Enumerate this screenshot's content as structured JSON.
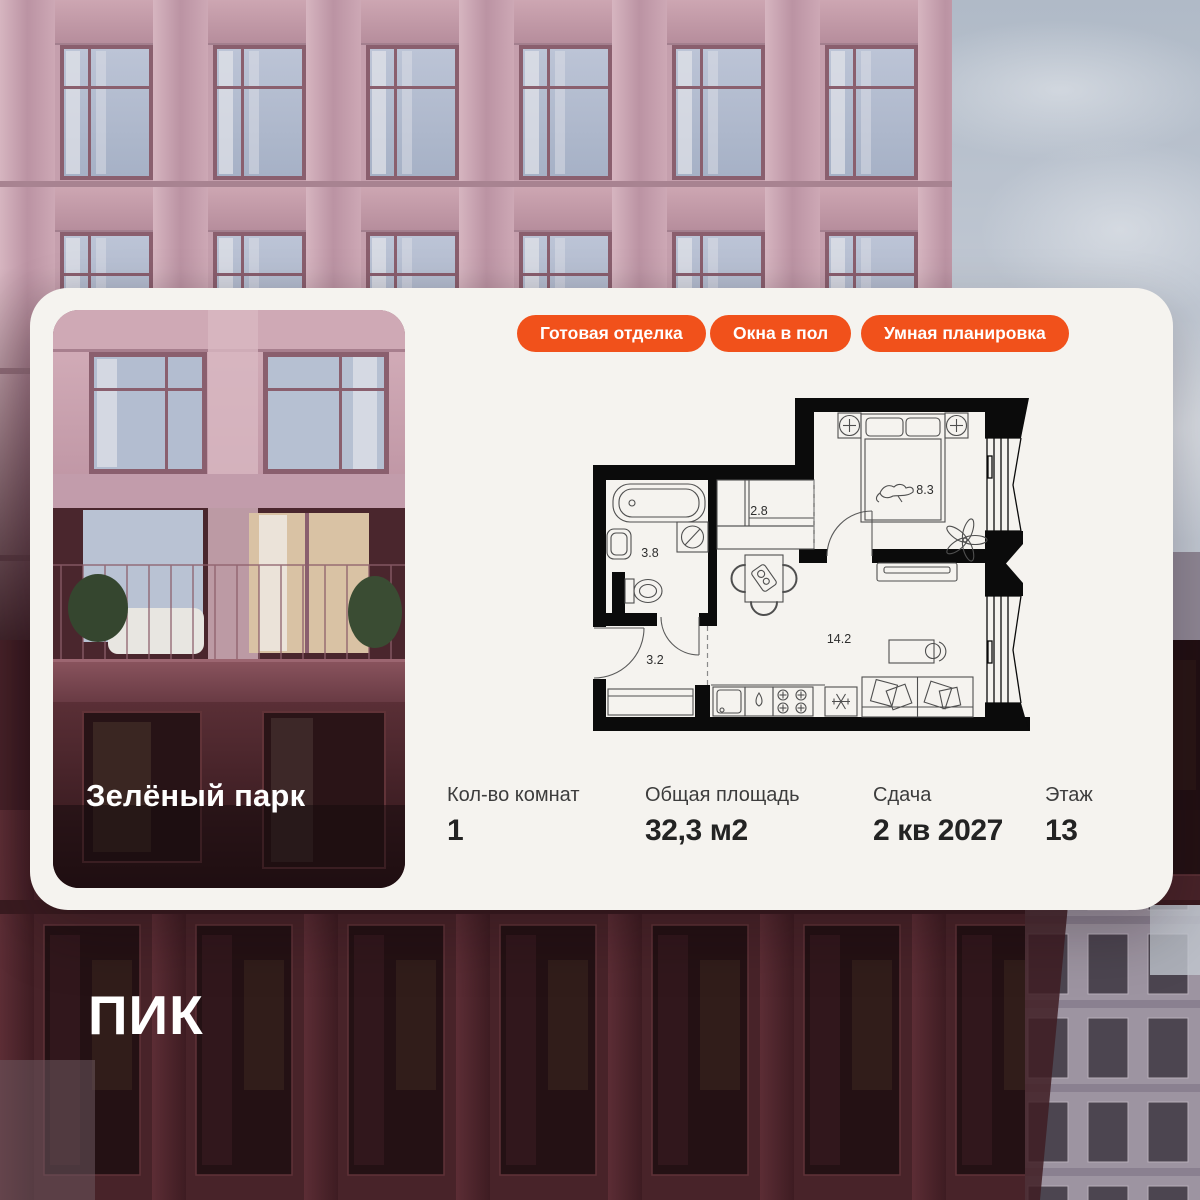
{
  "project": {
    "name": "Зелёный парк"
  },
  "developer": {
    "logo_text": "ПИК"
  },
  "badges": [
    {
      "label": "Готовая отделка"
    },
    {
      "label": "Окна в пол"
    },
    {
      "label": "Умная планировка"
    }
  ],
  "floor_plan": {
    "rooms": [
      {
        "name": "bathroom",
        "area": "3.8"
      },
      {
        "name": "wardrobe",
        "area": "2.8"
      },
      {
        "name": "bedroom",
        "area": "8.3"
      },
      {
        "name": "hallway",
        "area": "3.2"
      },
      {
        "name": "living-kitchen",
        "area": "14.2"
      }
    ]
  },
  "stats": [
    {
      "label": "Кол-во комнат",
      "value": "1"
    },
    {
      "label": "Общая площадь",
      "value": "32,3 м2"
    },
    {
      "label": "Сдача",
      "value": "2 кв 2027"
    },
    {
      "label": "Этаж",
      "value": "13"
    }
  ],
  "colors": {
    "accent": "#F1511B",
    "card_bg": "#F5F3EF",
    "plan_wall": "#0B0B0B",
    "sky": "#BCC4CF",
    "facade_pink": "#C6A0AE",
    "facade_dark": "#45222A"
  }
}
